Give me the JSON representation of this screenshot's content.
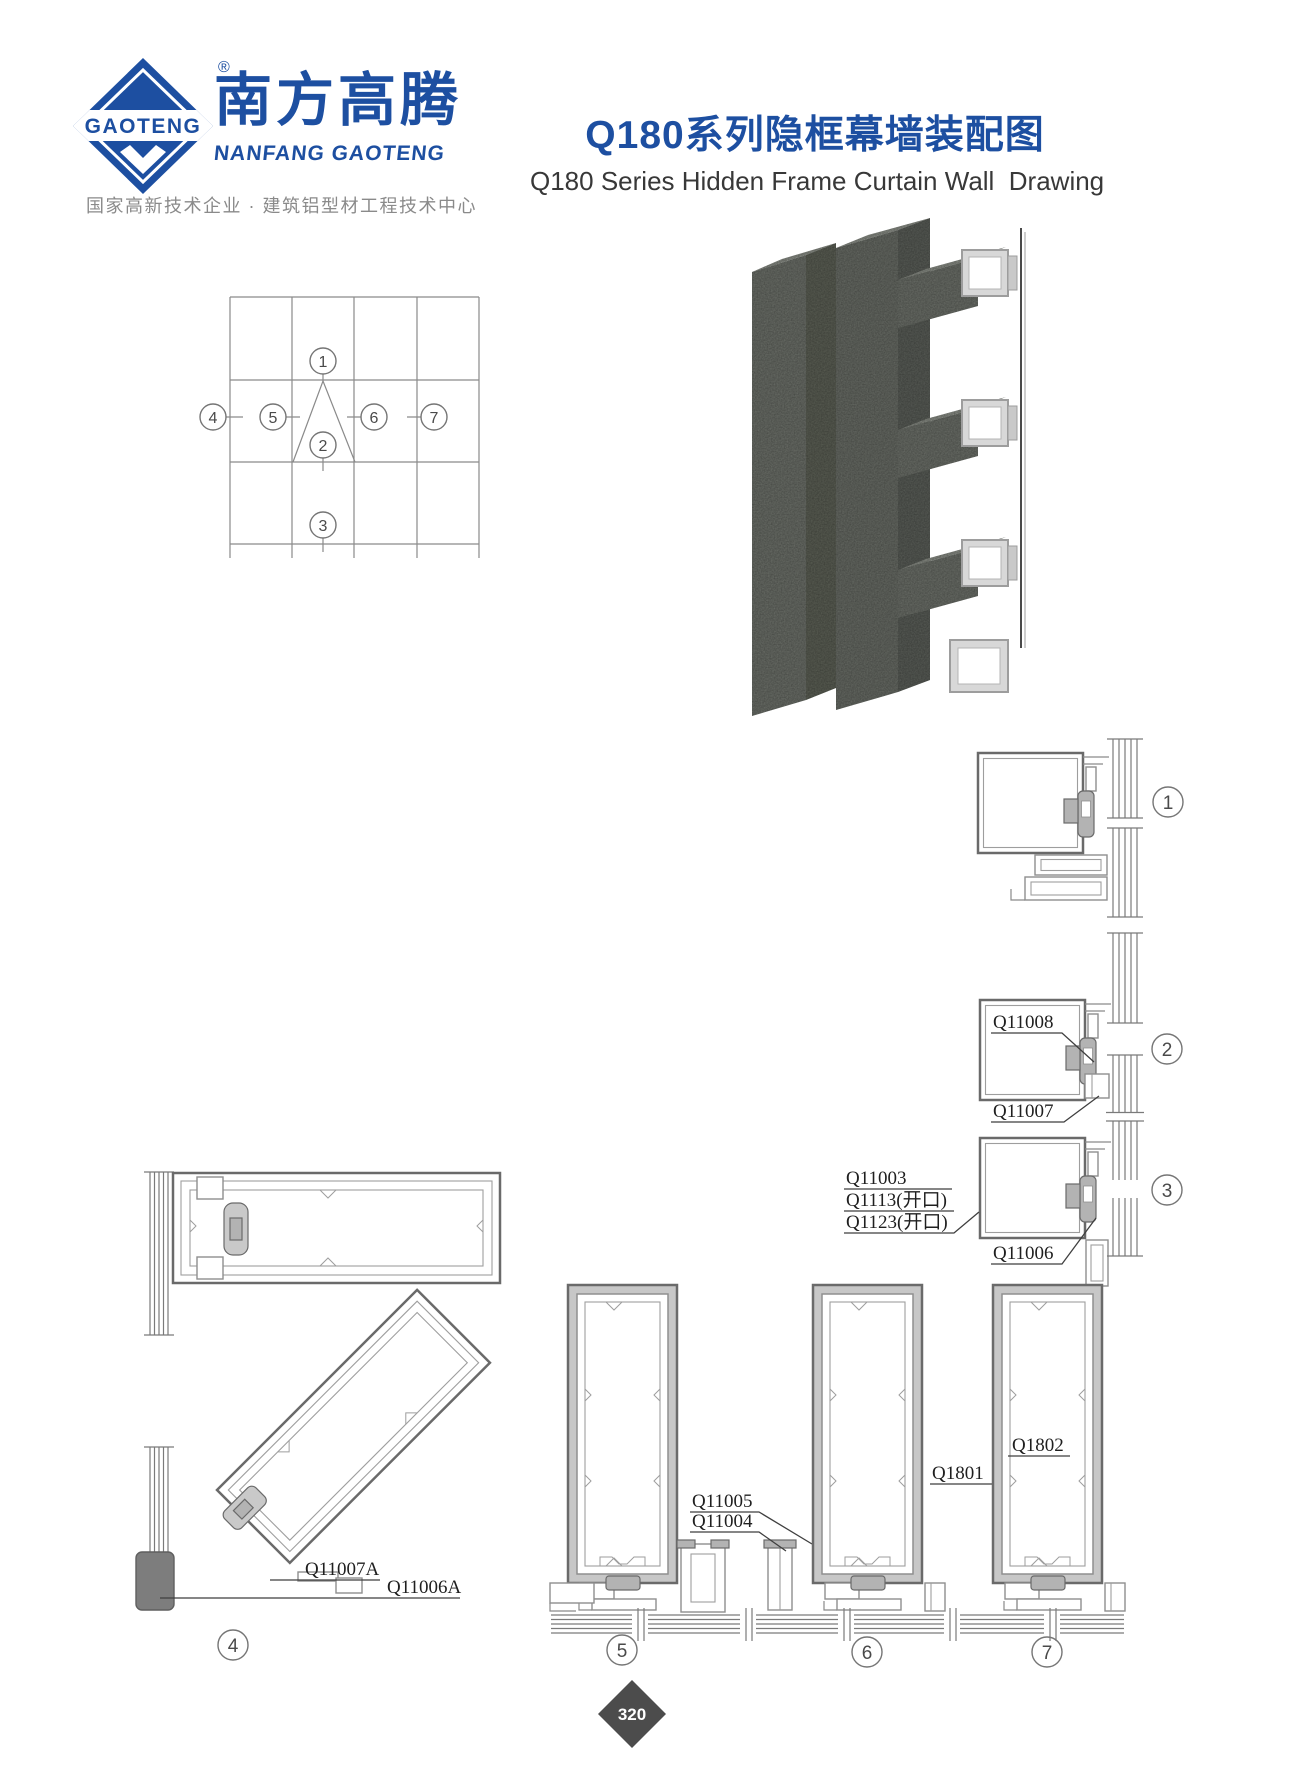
{
  "page": {
    "width": 1300,
    "height": 1775
  },
  "header": {
    "logo": {
      "brand": "GAOTENG",
      "registered": "®",
      "name_cn": "南方高腾",
      "name_en": "NANFANG GAOTENG",
      "tagline": "国家高新技术企业 · 建筑铝型材工程技术中心"
    },
    "title_cn": "Q180系列隐框幕墙装配图",
    "title_en": "Q180 Series Hidden Frame Curtain Wall  Drawing"
  },
  "colors": {
    "brand_blue": "#1d4fa1",
    "line_grey": "#8a8a8a",
    "dark_line": "#6a6a6a",
    "clamp_grey": "#b3b3b3",
    "concrete_grey": "#70746e",
    "badge_grey": "#4c4c4c"
  },
  "overview": {
    "markers": [
      "1",
      "2",
      "3",
      "4",
      "5",
      "6",
      "7"
    ]
  },
  "details": {
    "d1": {
      "num": "1"
    },
    "d2": {
      "num": "2",
      "labels": [
        "Q11008",
        "Q11007"
      ]
    },
    "d3": {
      "num": "3",
      "labels": [
        "Q11003",
        "Q1113(开口)",
        "Q1123(开口)",
        "Q11006"
      ]
    },
    "d4": {
      "num": "4",
      "labels": [
        "Q11007A",
        "Q11006A"
      ]
    },
    "d5": {
      "num": "5",
      "labels": [
        "Q11005",
        "Q11004"
      ]
    },
    "d6": {
      "num": "6",
      "label": "Q1801"
    },
    "d7": {
      "num": "7",
      "label": "Q1802"
    }
  },
  "footer": {
    "page_number": "320"
  }
}
